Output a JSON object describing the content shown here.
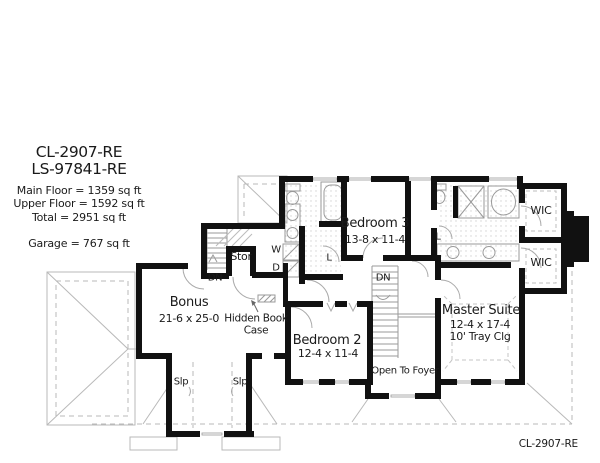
{
  "title_block": {
    "plan_code": "CL-2907-RE",
    "alt_code": "LS-97841-RE",
    "main_floor": "Main Floor = 1359 sq ft",
    "upper_floor": "Upper Floor = 1592 sq ft",
    "total": "Total = 2951 sq ft",
    "garage": "Garage = 767 sq ft"
  },
  "rooms": {
    "bonus": {
      "name": "Bonus",
      "dims": "21-6 x 25-0"
    },
    "bedroom2": {
      "name": "Bedroom 2",
      "dims": "12-4 x 11-4"
    },
    "bedroom3": {
      "name": "Bedroom 3",
      "dims": "13-8 x 11-4"
    },
    "master": {
      "name": "Master Suite",
      "dims": "12-4 x 17-4",
      "note": "10' Tray Clg"
    },
    "wic_top": "WIC",
    "wic_bottom": "WIC",
    "stor": "Stor",
    "open_to_foyer": "Open To Foyer",
    "hidden_bookcase": "Hidden Book Case"
  },
  "annotations": {
    "dn_back": "DN",
    "dn_main": "DN",
    "washer": "W",
    "dryer": "D",
    "linen_hall": "L",
    "linen_master": "L",
    "slope_left": "Slp",
    "slope_right": "Slp"
  },
  "footer": {
    "plan_code": "CL-2907-RE"
  },
  "colors": {
    "wall": "#111111",
    "roof_line": "#b9b9b9",
    "fixture_line": "#9a9a9a",
    "text": "#1a1a1a"
  }
}
